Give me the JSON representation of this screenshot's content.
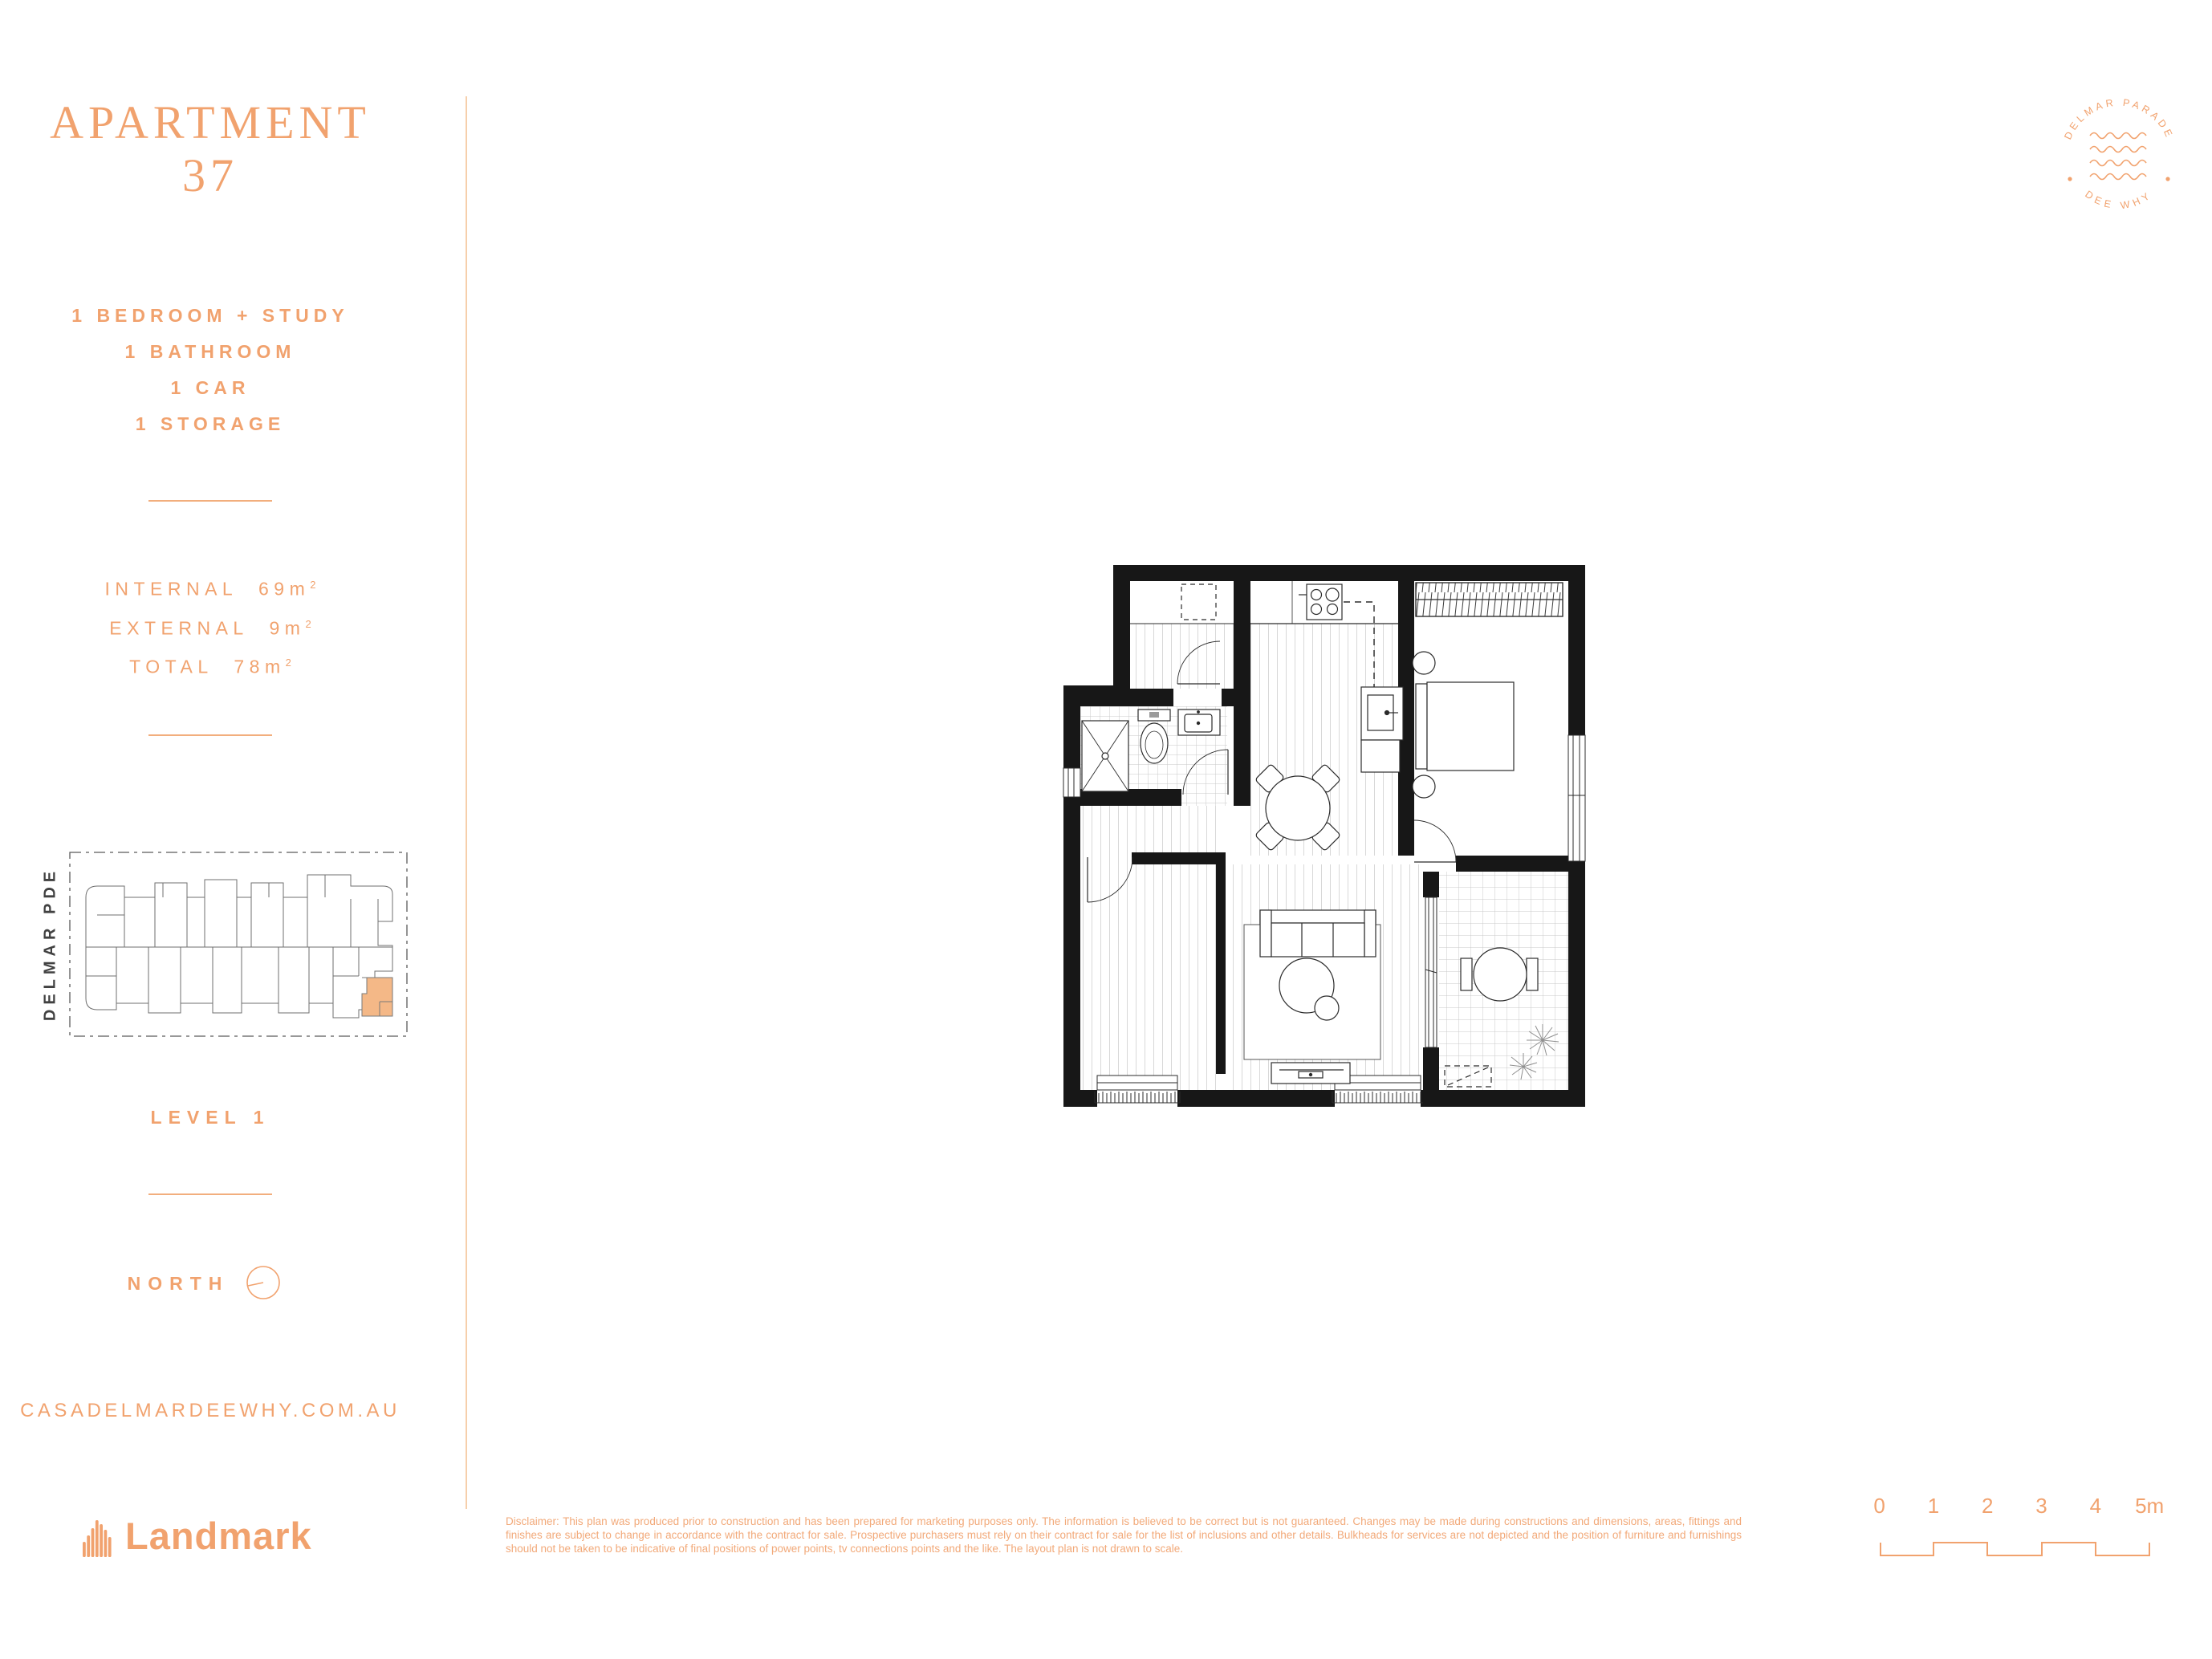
{
  "accent": "#F1A26E",
  "highlight": "#F4B887",
  "sidebar": {
    "title": {
      "line1": "APARTMENT",
      "line2": "37"
    },
    "features": [
      "1 BEDROOM + STUDY",
      "1 BATHROOM",
      "1 CAR",
      "1 STORAGE"
    ],
    "areas": [
      {
        "label": "INTERNAL",
        "value": "69m",
        "sup": "2"
      },
      {
        "label": "EXTERNAL",
        "value": "9m",
        "sup": "2"
      },
      {
        "label": "TOTAL",
        "value": "78m",
        "sup": "2"
      }
    ],
    "keyplan": {
      "street": "DELMAR PDE",
      "level": "LEVEL 1"
    },
    "north_label": "NORTH",
    "website": "CASADELMARDEEWHY.COM.AU"
  },
  "brand": {
    "name": "Landmark"
  },
  "stamp": {
    "arc_top": "DELMAR PARADE",
    "arc_bottom": "DEE WHY"
  },
  "footer": {
    "disclaimer": "Disclaimer: This plan was produced prior to construction and has been prepared for marketing purposes only.  The information is believed to be correct but is not guaranteed.  Changes may be made during constructions and dimensions, areas, fittings and finishes are subject to change in accordance with the contract for sale.  Prospective purchasers must rely on their contract for sale for the list of inclusions and other details.  Bulkheads for services are not depicted and the position of furniture and furnishings should not be taken to be indicative of final positions of power points, tv connections points and the like. The layout plan is not drawn to scale.",
    "scale_labels": [
      "0",
      "1",
      "2",
      "3",
      "4",
      "5m"
    ]
  }
}
